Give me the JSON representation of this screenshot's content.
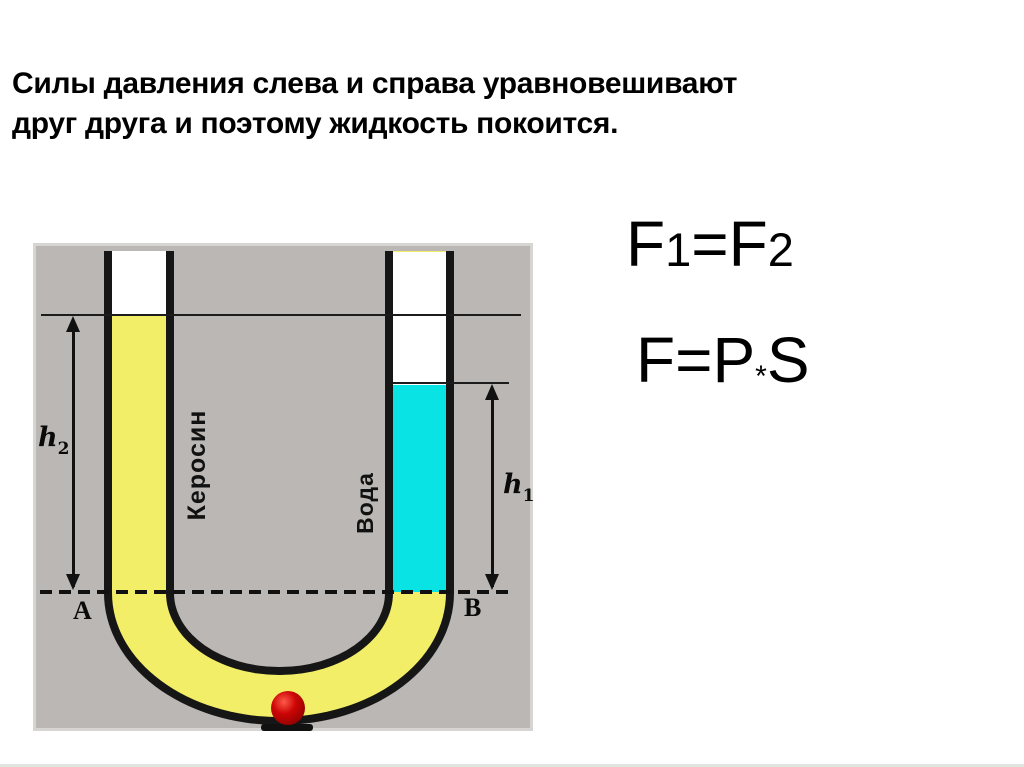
{
  "title": {
    "line1": "Силы давления слева и справа уравновешивают",
    "line2": "друг друга и поэтому жидкость покоится."
  },
  "formulas": {
    "force_equality": {
      "f_left": "F",
      "sub_left": "1",
      "equals": "=",
      "f_right": "F",
      "sub_right": "2"
    },
    "force_definition": {
      "f": "F",
      "equals": "=",
      "p": "P",
      "times": "*",
      "s": "S"
    }
  },
  "diagram": {
    "left_liquid_label": "Керосин",
    "right_liquid_label": "Вода",
    "point_left": "A",
    "point_right": "B",
    "height_left": {
      "letter": "h",
      "sub": "2"
    },
    "height_right": {
      "letter": "h",
      "sub": "1"
    }
  },
  "colors": {
    "kerosene": "#f2ee68",
    "water": "#0ae3e3",
    "panel_bg": "#bab7b4",
    "panel_border": "#d7d5d1",
    "tube_outline": "#161616",
    "ball_red": "#cc0505",
    "text": "#000000"
  }
}
